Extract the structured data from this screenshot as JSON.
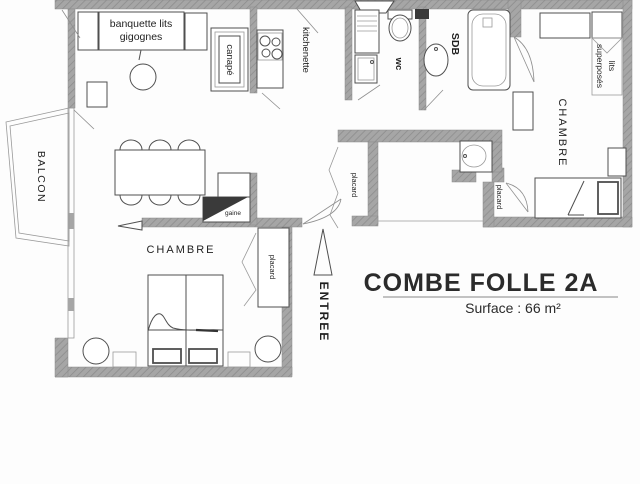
{
  "plan": {
    "title": "COMBE FOLLE 2A",
    "surface": "Surface : 66 m²",
    "labels": {
      "banquette_line1": "banquette lits",
      "banquette_line2": "gigognes",
      "canape": "canapé",
      "kitchenette": "kitchenette",
      "wc": "wc",
      "sdb": "SDB",
      "bunk_line1": "lits",
      "bunk_line2": "superposés",
      "chambre_right": "CHAMBRE",
      "chambre_left": "CHAMBRE",
      "balcon": "BALCON",
      "placard_hall": "placard",
      "placard_right": "placard",
      "placard_bedroom": "placard",
      "gaine": "gaine",
      "entree": "ENTREE"
    },
    "colors": {
      "wall": "#a6a6a6",
      "wall-hatch": "#8d8d8d",
      "line": "#4f4f4f",
      "dark": "#3a3a3a",
      "text": "#1f1f1f",
      "background": "#fdfdfd"
    }
  }
}
